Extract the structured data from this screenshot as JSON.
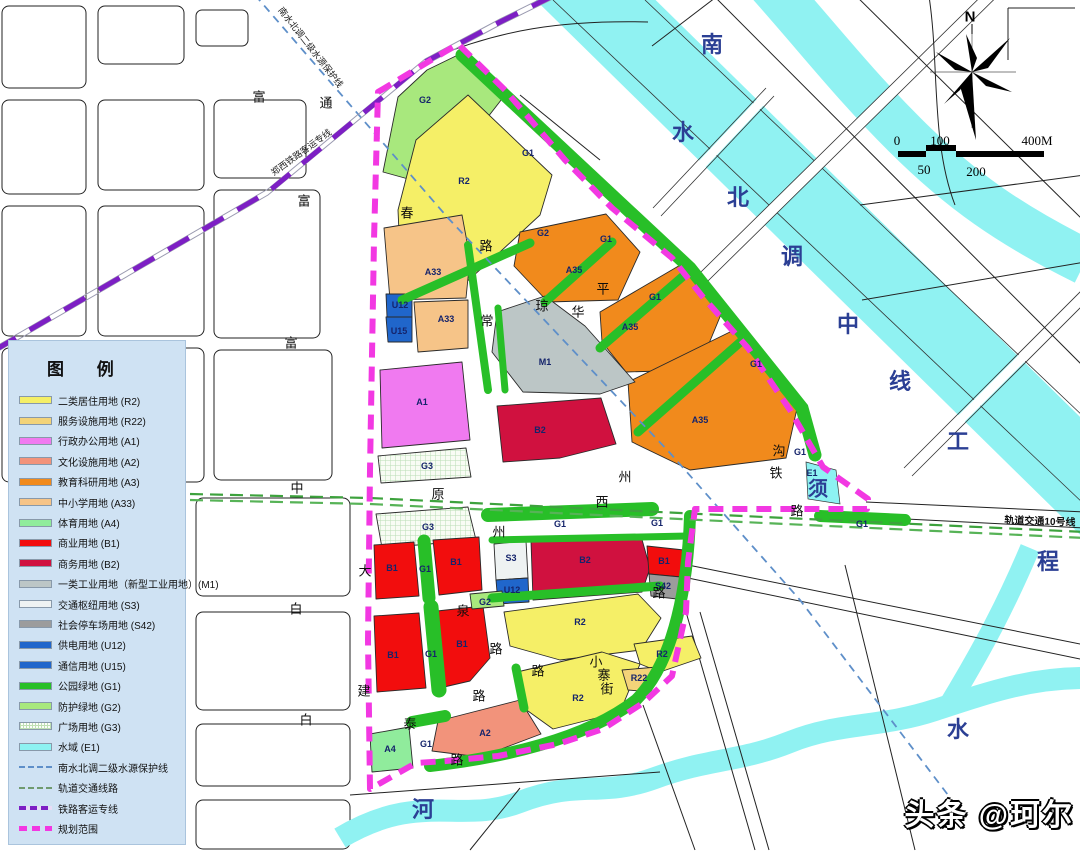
{
  "legend": {
    "title": "图  例",
    "items": [
      {
        "label": "二类居住用地 (R2)",
        "swatch": "R2"
      },
      {
        "label": "服务设施用地 (R22)",
        "swatch": "R22"
      },
      {
        "label": "行政办公用地 (A1)",
        "swatch": "A1"
      },
      {
        "label": "文化设施用地 (A2)",
        "swatch": "A2"
      },
      {
        "label": "教育科研用地 (A3)",
        "swatch": "A3"
      },
      {
        "label": "中小学用地 (A33)",
        "swatch": "A33"
      },
      {
        "label": "体育用地 (A4)",
        "swatch": "A4"
      },
      {
        "label": "商业用地 (B1)",
        "swatch": "B1"
      },
      {
        "label": "商务用地 (B2)",
        "swatch": "B2"
      },
      {
        "label": "一类工业用地（新型工业用地）(M1)",
        "swatch": "M1"
      },
      {
        "label": "交通枢纽用地 (S3)",
        "swatch": "S3"
      },
      {
        "label": "社会停车场用地 (S42)",
        "swatch": "S42"
      },
      {
        "label": "供电用地 (U12)",
        "swatch": "U12"
      },
      {
        "label": "通信用地 (U15)",
        "swatch": "U15"
      },
      {
        "label": "公园绿地 (G1)",
        "swatch": "G1"
      },
      {
        "label": "防护绿地 (G2)",
        "swatch": "G2"
      },
      {
        "label": "广场用地 (G3)",
        "swatch": "hatch"
      },
      {
        "label": "水域 (E1)",
        "swatch": "E1"
      },
      {
        "label": "南水北调二级水源保护线",
        "swatch": "line-protect"
      },
      {
        "label": "轨道交通线路",
        "swatch": "line-transit"
      },
      {
        "label": "铁路客运专线",
        "swatch": "line-rail"
      },
      {
        "label": "规划范围",
        "swatch": "line-boundary"
      }
    ]
  },
  "north": {
    "label": "N"
  },
  "scalebar": {
    "top": [
      "0",
      "100",
      "400M"
    ],
    "bottom": [
      "50",
      "200"
    ]
  },
  "watermark": "头条 @珂尔",
  "labels": {
    "parcels": [
      {
        "t": "G2",
        "x": 425,
        "y": 100
      },
      {
        "t": "G1",
        "x": 528,
        "y": 153
      },
      {
        "t": "R2",
        "x": 464,
        "y": 181
      },
      {
        "t": "G2",
        "x": 543,
        "y": 233
      },
      {
        "t": "G1",
        "x": 606,
        "y": 239
      },
      {
        "t": "A35",
        "x": 574,
        "y": 270
      },
      {
        "t": "A33",
        "x": 433,
        "y": 272
      },
      {
        "t": "U12",
        "x": 400,
        "y": 305
      },
      {
        "t": "U15",
        "x": 399,
        "y": 331
      },
      {
        "t": "A33",
        "x": 446,
        "y": 319
      },
      {
        "t": "G1",
        "x": 655,
        "y": 297
      },
      {
        "t": "A35",
        "x": 630,
        "y": 327
      },
      {
        "t": "M1",
        "x": 545,
        "y": 362
      },
      {
        "t": "A1",
        "x": 422,
        "y": 402
      },
      {
        "t": "B2",
        "x": 540,
        "y": 430
      },
      {
        "t": "A35",
        "x": 700,
        "y": 420
      },
      {
        "t": "G1",
        "x": 756,
        "y": 364
      },
      {
        "t": "G1",
        "x": 800,
        "y": 452
      },
      {
        "t": "G3",
        "x": 427,
        "y": 466
      },
      {
        "t": "E1",
        "x": 812,
        "y": 473
      },
      {
        "t": "G3",
        "x": 428,
        "y": 527
      },
      {
        "t": "G1",
        "x": 560,
        "y": 524
      },
      {
        "t": "G1",
        "x": 657,
        "y": 523
      },
      {
        "t": "G1",
        "x": 862,
        "y": 524
      },
      {
        "t": "B1",
        "x": 392,
        "y": 568
      },
      {
        "t": "G1",
        "x": 425,
        "y": 569
      },
      {
        "t": "B1",
        "x": 456,
        "y": 562
      },
      {
        "t": "S3",
        "x": 511,
        "y": 558
      },
      {
        "t": "U12",
        "x": 512,
        "y": 590
      },
      {
        "t": "B2",
        "x": 585,
        "y": 560
      },
      {
        "t": "B1",
        "x": 664,
        "y": 561
      },
      {
        "t": "S42",
        "x": 663,
        "y": 586
      },
      {
        "t": "G2",
        "x": 485,
        "y": 602
      },
      {
        "t": "R2",
        "x": 580,
        "y": 622
      },
      {
        "t": "B1",
        "x": 393,
        "y": 655
      },
      {
        "t": "G1",
        "x": 431,
        "y": 654
      },
      {
        "t": "B1",
        "x": 462,
        "y": 644
      },
      {
        "t": "R2",
        "x": 662,
        "y": 654
      },
      {
        "t": "R22",
        "x": 639,
        "y": 678
      },
      {
        "t": "R2",
        "x": 578,
        "y": 698
      },
      {
        "t": "A2",
        "x": 485,
        "y": 733
      },
      {
        "t": "A4",
        "x": 390,
        "y": 749
      },
      {
        "t": "G1",
        "x": 426,
        "y": 744
      }
    ],
    "roads": [
      {
        "t": "富",
        "x": 259,
        "y": 96
      },
      {
        "t": "通",
        "x": 326,
        "y": 102
      },
      {
        "t": "富",
        "x": 304,
        "y": 200
      },
      {
        "t": "富",
        "x": 291,
        "y": 342
      },
      {
        "t": "中",
        "x": 297,
        "y": 487
      },
      {
        "t": "原",
        "x": 438,
        "y": 493
      },
      {
        "t": "西",
        "x": 602,
        "y": 501
      },
      {
        "t": "州",
        "x": 625,
        "y": 476
      },
      {
        "t": "州",
        "x": 499,
        "y": 531
      },
      {
        "t": "春",
        "x": 407,
        "y": 212
      },
      {
        "t": "路",
        "x": 486,
        "y": 245
      },
      {
        "t": "常",
        "x": 487,
        "y": 320
      },
      {
        "t": "琼",
        "x": 542,
        "y": 305
      },
      {
        "t": "华",
        "x": 578,
        "y": 311
      },
      {
        "t": "平",
        "x": 603,
        "y": 288
      },
      {
        "t": "大",
        "x": 365,
        "y": 570
      },
      {
        "t": "建",
        "x": 364,
        "y": 690
      },
      {
        "t": "白",
        "x": 296,
        "y": 608
      },
      {
        "t": "白",
        "x": 306,
        "y": 719
      },
      {
        "t": "泉",
        "x": 463,
        "y": 610
      },
      {
        "t": "路",
        "x": 496,
        "y": 648
      },
      {
        "t": "路",
        "x": 538,
        "y": 670
      },
      {
        "t": "路",
        "x": 479,
        "y": 695
      },
      {
        "t": "泰",
        "x": 410,
        "y": 723
      },
      {
        "t": "路",
        "x": 457,
        "y": 759
      },
      {
        "t": "小",
        "x": 596,
        "y": 661
      },
      {
        "t": "寨",
        "x": 604,
        "y": 674
      },
      {
        "t": "街",
        "x": 607,
        "y": 688
      },
      {
        "t": "路",
        "x": 659,
        "y": 592
      },
      {
        "t": "沟",
        "x": 779,
        "y": 450
      },
      {
        "t": "铁",
        "x": 776,
        "y": 472
      },
      {
        "t": "路",
        "x": 797,
        "y": 510
      }
    ],
    "water": [
      {
        "t": "南",
        "x": 712,
        "y": 43,
        "s": 22
      },
      {
        "t": "水",
        "x": 683,
        "y": 131,
        "s": 22
      },
      {
        "t": "北",
        "x": 738,
        "y": 196,
        "s": 22
      },
      {
        "t": "调",
        "x": 792,
        "y": 255,
        "s": 22
      },
      {
        "t": "中",
        "x": 848,
        "y": 323,
        "s": 22
      },
      {
        "t": "线",
        "x": 900,
        "y": 380,
        "s": 22
      },
      {
        "t": "工",
        "x": 958,
        "y": 440,
        "s": 22
      },
      {
        "t": "程",
        "x": 1048,
        "y": 560,
        "s": 22
      },
      {
        "t": "须",
        "x": 818,
        "y": 487,
        "s": 20
      },
      {
        "t": "河",
        "x": 423,
        "y": 808,
        "s": 22
      },
      {
        "t": "水",
        "x": 958,
        "y": 728,
        "s": 22
      }
    ],
    "lines": [
      {
        "t": "南水北调二级水源保护线",
        "x": 311,
        "y": 47,
        "r": 52,
        "cls": "line-lbl"
      },
      {
        "t": "郑西铁路客运专线",
        "x": 301,
        "y": 152,
        "r": -36,
        "cls": "line-lbl"
      },
      {
        "t": "轨道交通10号线",
        "x": 1040,
        "y": 520,
        "r": 2,
        "cls": "transit-lbl"
      }
    ]
  },
  "colors": {
    "R2": "#f5ef67",
    "R22": "#f3d379",
    "A1": "#f07af0",
    "A2": "#f2937b",
    "A3": "#f18a1c",
    "A33": "#f6c488",
    "A4": "#90ec9c",
    "B1": "#f20d0d",
    "B2": "#d0113f",
    "M1": "#bcc6c6",
    "S3": "#eef2f2",
    "S42": "#9c9c9c",
    "U12": "#2066cb",
    "U15": "#2066cb",
    "G1": "#28bf28",
    "G2": "#a8e87d",
    "E1": "#8df2f2",
    "boundary": "#f238e2",
    "railway": "#7d1fc4",
    "protect_line": "#5e8fc9",
    "transit_line": "#3da23d",
    "water": "#90f2f2",
    "legend_bg": "#cfe2f3"
  }
}
